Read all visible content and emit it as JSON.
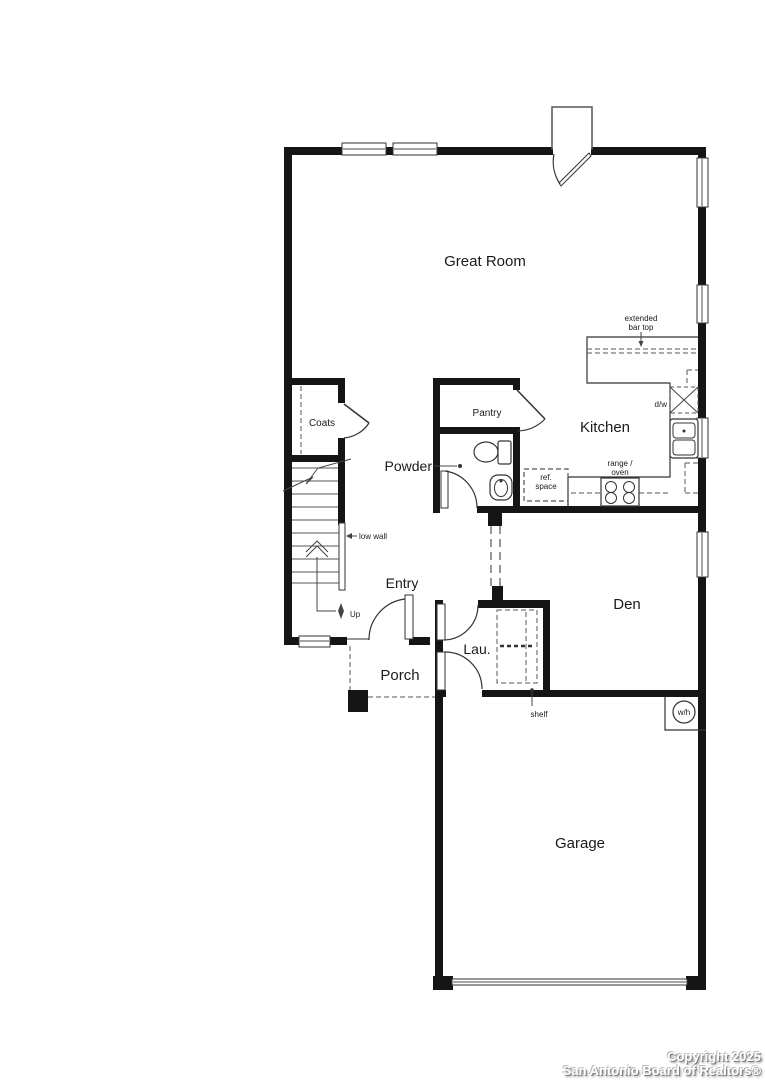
{
  "plan": {
    "title": "single-story-floor-plan",
    "rooms": {
      "great_room": "Great Room",
      "kitchen": "Kitchen",
      "pantry": "Pantry",
      "powder": "Powder",
      "coats": "Coats",
      "entry": "Entry",
      "porch": "Porch",
      "laundry": "Lau.",
      "den": "Den",
      "garage": "Garage"
    },
    "annotations": {
      "extended_bar_top_line1": "extended",
      "extended_bar_top_line2": "bar top",
      "dishwasher": "d/w",
      "range_line1": "range /",
      "range_line2": "oven",
      "ref_line1": "ref.",
      "ref_line2": "space",
      "low_wall": "low wall",
      "up": "Up",
      "shelf": "shelf",
      "water_heater": "w/h"
    },
    "colors": {
      "wall": "#151515",
      "line": "#555555",
      "text": "#1a1a1a",
      "background": "#ffffff"
    }
  },
  "footer": {
    "copyright": "Copyright 2025",
    "organization": "San Antonio Board of Realtors®"
  }
}
